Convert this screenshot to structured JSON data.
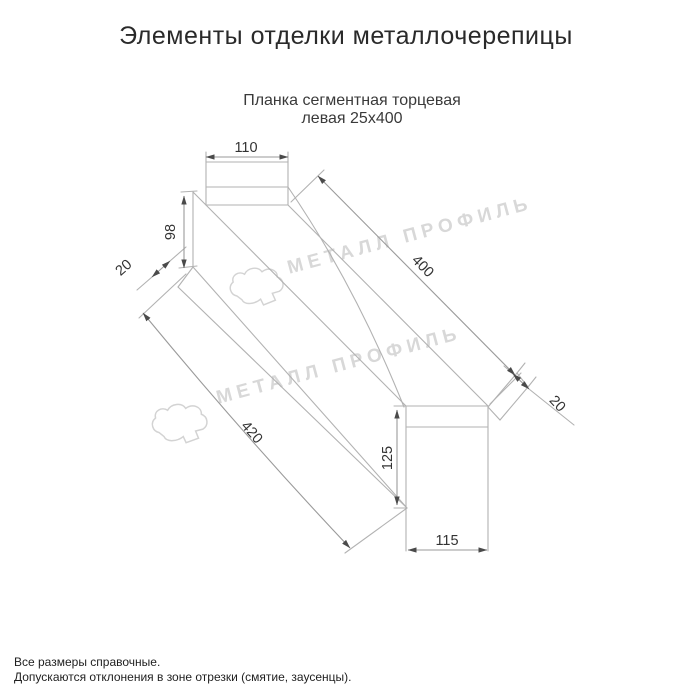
{
  "page": {
    "title": "Элементы отделки металлочерепицы"
  },
  "product": {
    "subtitle_line1": "Планка сегментная торцевая",
    "subtitle_line2": "левая 25х400"
  },
  "drawing": {
    "type": "technical-dimension-sketch",
    "dims": {
      "top_flange_width": "110",
      "near_end_height": "98",
      "near_hem": "20",
      "top_edge_length": "400",
      "far_hem": "20",
      "bottom_edge_length": "420",
      "far_end_height": "125",
      "far_flange_width": "115"
    }
  },
  "watermark": {
    "text": "МЕТАЛЛ ПРОФИЛЬ",
    "logo": "metall-profil-cloud-logo"
  },
  "footer": {
    "line1": "Все размеры справочные.",
    "line2": "Допускаются отклонения в зоне отрезки (смятие, заусенцы)."
  },
  "colors": {
    "background": "#ffffff",
    "outline": "#b2b2b2",
    "dimension_line": "#9a9a9a",
    "arrow": "#4a4a4a",
    "dim_text": "#333333",
    "title_text": "#2a2a2a",
    "watermark": "#d8d8d8"
  }
}
